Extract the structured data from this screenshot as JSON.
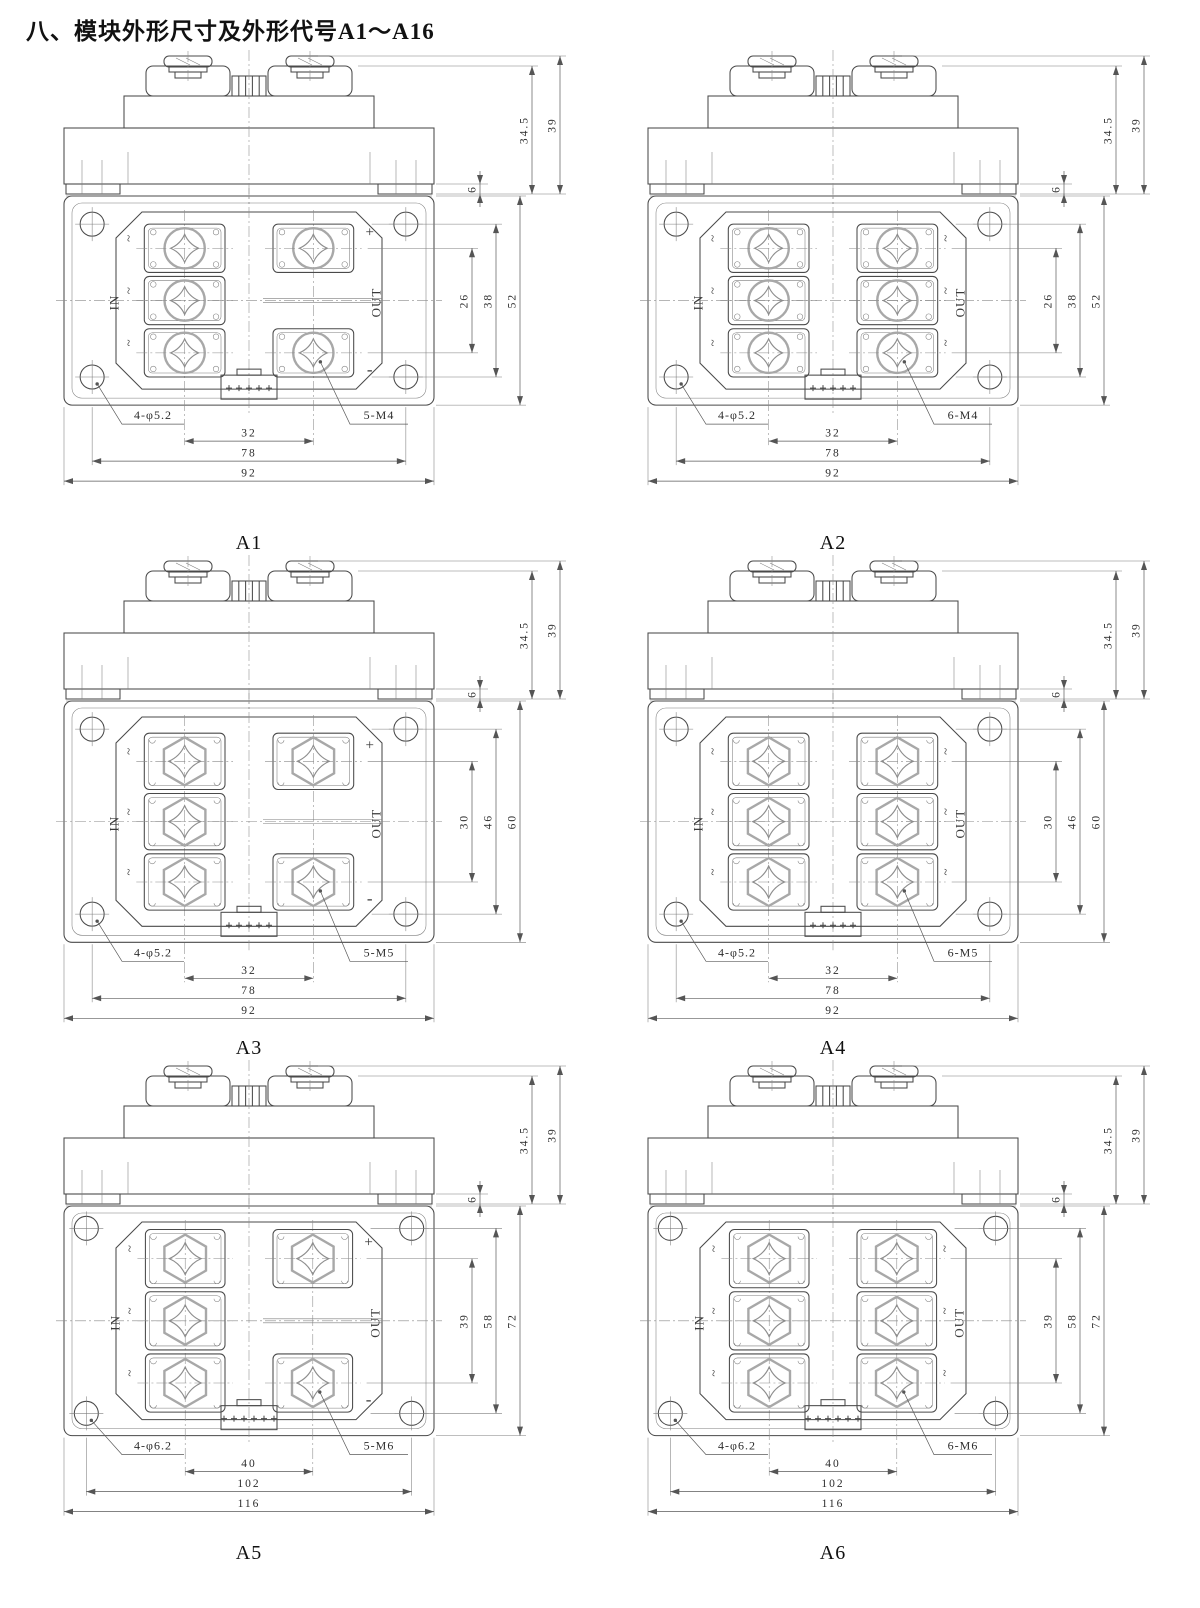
{
  "page": {
    "title": "八、模块外形尺寸及外形代号A1～A16"
  },
  "modules": [
    {
      "code": "A1",
      "side_dims": {
        "body_height": "34.5",
        "total_height": "39",
        "foot_height": "6"
      },
      "plan_dims": {
        "terminal_row_pitch": "26",
        "terminal_span": "38",
        "overall_height": "52"
      },
      "bottom_dims": {
        "mount_holes": "4-φ5.2",
        "terminal_pitch": "32",
        "terminal_screws": "5-M4",
        "hole_pitch": "78",
        "overall_width": "92"
      },
      "in_label": "IN",
      "out_label": "OUT",
      "ac_mark": "~",
      "polarity_top": "+",
      "polarity_bottom": "-",
      "in_terminals": 3,
      "out_terminals": 2,
      "screw_style": "round",
      "connector_pins": 5
    },
    {
      "code": "A2",
      "side_dims": {
        "body_height": "34.5",
        "total_height": "39",
        "foot_height": "6"
      },
      "plan_dims": {
        "terminal_row_pitch": "26",
        "terminal_span": "38",
        "overall_height": "52"
      },
      "bottom_dims": {
        "mount_holes": "4-φ5.2",
        "terminal_pitch": "32",
        "terminal_screws": "6-M4",
        "hole_pitch": "78",
        "overall_width": "92"
      },
      "in_label": "IN",
      "out_label": "OUT",
      "ac_mark": "~",
      "polarity_top": "",
      "polarity_bottom": "",
      "in_terminals": 3,
      "out_terminals": 3,
      "screw_style": "round",
      "connector_pins": 5
    },
    {
      "code": "A3",
      "side_dims": {
        "body_height": "34.5",
        "total_height": "39",
        "foot_height": "6"
      },
      "plan_dims": {
        "terminal_row_pitch": "30",
        "terminal_span": "46",
        "overall_height": "60"
      },
      "bottom_dims": {
        "mount_holes": "4-φ5.2",
        "terminal_pitch": "32",
        "terminal_screws": "5-M5",
        "hole_pitch": "78",
        "overall_width": "92"
      },
      "in_label": "IN",
      "out_label": "OUT",
      "ac_mark": "~",
      "polarity_top": "+",
      "polarity_bottom": "-",
      "in_terminals": 3,
      "out_terminals": 2,
      "screw_style": "hex",
      "connector_pins": 5
    },
    {
      "code": "A4",
      "side_dims": {
        "body_height": "34.5",
        "total_height": "39",
        "foot_height": "6"
      },
      "plan_dims": {
        "terminal_row_pitch": "30",
        "terminal_span": "46",
        "overall_height": "60"
      },
      "bottom_dims": {
        "mount_holes": "4-φ5.2",
        "terminal_pitch": "32",
        "terminal_screws": "6-M5",
        "hole_pitch": "78",
        "overall_width": "92"
      },
      "in_label": "IN",
      "out_label": "OUT",
      "ac_mark": "~",
      "polarity_top": "",
      "polarity_bottom": "",
      "in_terminals": 3,
      "out_terminals": 3,
      "screw_style": "hex",
      "connector_pins": 5
    },
    {
      "code": "A5",
      "side_dims": {
        "body_height": "34.5",
        "total_height": "39",
        "foot_height": "6"
      },
      "plan_dims": {
        "terminal_row_pitch": "39",
        "terminal_span": "58",
        "overall_height": "72"
      },
      "bottom_dims": {
        "mount_holes": "4-φ6.2",
        "terminal_pitch": "40",
        "terminal_screws": "5-M6",
        "hole_pitch": "102",
        "overall_width": "116"
      },
      "in_label": "IN",
      "out_label": "OUT",
      "ac_mark": "~",
      "polarity_top": "+",
      "polarity_bottom": "-",
      "in_terminals": 3,
      "out_terminals": 2,
      "screw_style": "hex",
      "connector_pins": 6
    },
    {
      "code": "A6",
      "side_dims": {
        "body_height": "34.5",
        "total_height": "39",
        "foot_height": "6"
      },
      "plan_dims": {
        "terminal_row_pitch": "39",
        "terminal_span": "58",
        "overall_height": "72"
      },
      "bottom_dims": {
        "mount_holes": "4-φ6.2",
        "terminal_pitch": "40",
        "terminal_screws": "6-M6",
        "hole_pitch": "102",
        "overall_width": "116"
      },
      "in_label": "IN",
      "out_label": "OUT",
      "ac_mark": "~",
      "polarity_top": "",
      "polarity_bottom": "",
      "in_terminals": 3,
      "out_terminals": 3,
      "screw_style": "hex",
      "connector_pins": 6
    }
  ]
}
